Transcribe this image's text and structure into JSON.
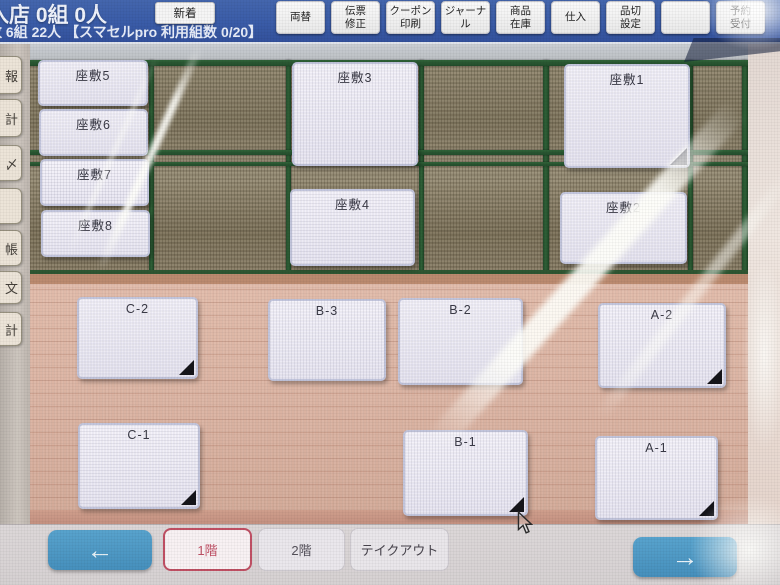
{
  "header": {
    "stats_line1": "入店 0組 0人",
    "stats_line2": "数 6組 22人 【スマセルpro 利用組数 0/20】",
    "new_button_label": "新着",
    "menu_buttons": [
      "両替",
      "伝票\n修正",
      "クーポン\n印刷",
      "ジャーナル",
      "商品\n在庫",
      "仕入",
      "品切\n設定",
      "",
      "予約\n受付"
    ]
  },
  "sidebar": {
    "partial_button_labels": [
      "報",
      "計",
      "〆",
      "",
      "帳",
      "文",
      "計"
    ]
  },
  "floor_map": {
    "tatami_tables": [
      {
        "id": "zashiki-5",
        "label": "座敷5",
        "corner_mark": false
      },
      {
        "id": "zashiki-6",
        "label": "座敷6",
        "corner_mark": false
      },
      {
        "id": "zashiki-7",
        "label": "座敷7",
        "corner_mark": false
      },
      {
        "id": "zashiki-8",
        "label": "座敷8",
        "corner_mark": false
      },
      {
        "id": "zashiki-3",
        "label": "座敷3",
        "corner_mark": false
      },
      {
        "id": "zashiki-4",
        "label": "座敷4",
        "corner_mark": false
      },
      {
        "id": "zashiki-1",
        "label": "座敷1",
        "corner_mark": true
      },
      {
        "id": "zashiki-2",
        "label": "座敷2",
        "corner_mark": false
      }
    ],
    "wood_tables": [
      {
        "id": "C-2",
        "label": "C-2",
        "corner_mark": true
      },
      {
        "id": "B-3",
        "label": "B-3",
        "corner_mark": false
      },
      {
        "id": "B-2",
        "label": "B-2",
        "corner_mark": false
      },
      {
        "id": "A-2",
        "label": "A-2",
        "corner_mark": true
      },
      {
        "id": "C-1",
        "label": "C-1",
        "corner_mark": true
      },
      {
        "id": "B-1",
        "label": "B-1",
        "corner_mark": true
      },
      {
        "id": "A-1",
        "label": "A-1",
        "corner_mark": true
      }
    ]
  },
  "bottom_nav": {
    "prev_arrow": "←",
    "next_arrow": "→",
    "floor_tabs": [
      {
        "label": "1階",
        "selected": true
      },
      {
        "label": "2階",
        "selected": false
      },
      {
        "label": "テイクアウト",
        "selected": false
      }
    ]
  },
  "colors": {
    "header_blue": "#3a5ca8",
    "nav_arrow_blue": "#4a96c4",
    "selected_tab_red": "#c05060",
    "tatami_green_grid": "#2b5a33",
    "wood_floor_pink": "#dcb4a3"
  }
}
